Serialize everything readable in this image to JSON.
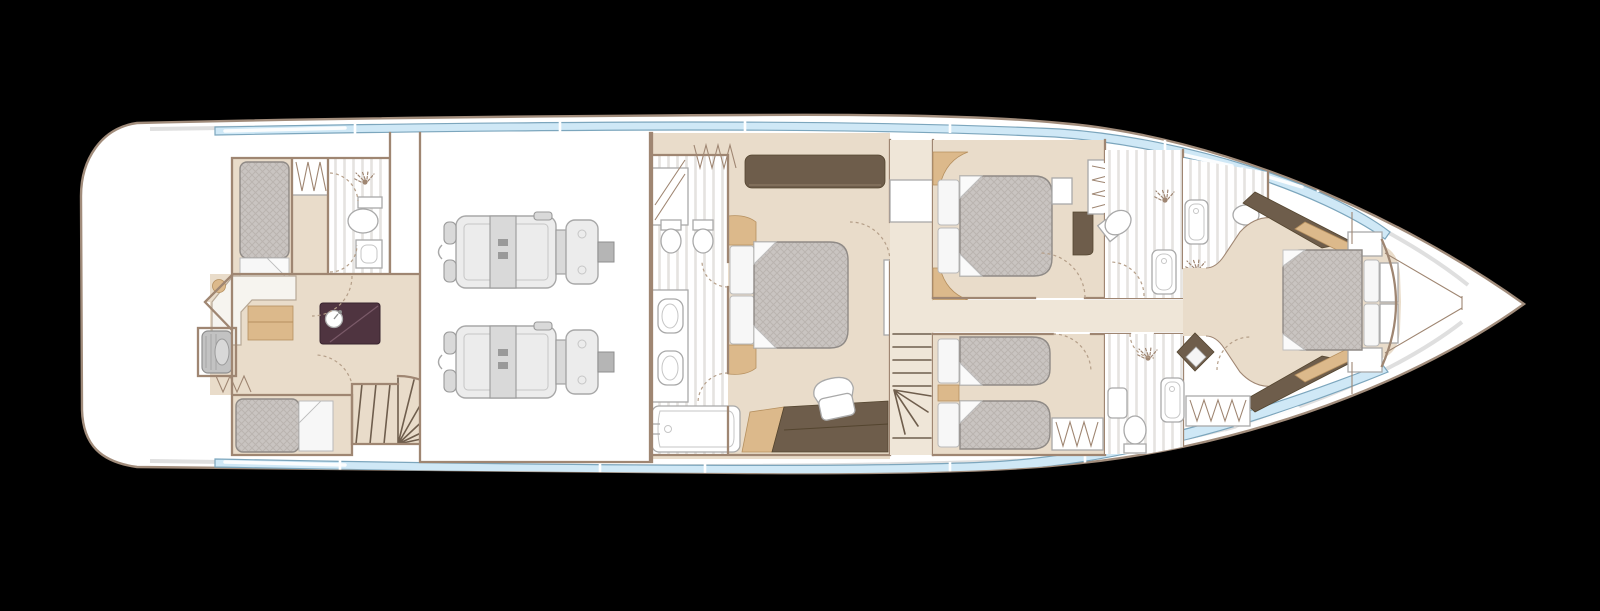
{
  "canvas": {
    "width": 1600,
    "height": 611,
    "background": "#000000"
  },
  "colors": {
    "background": "#000000",
    "hullFill": "#ffffff",
    "hullStroke": "#a18c7b",
    "deckShadow": "#d9d9d9",
    "glass": "#cfe8f6",
    "glassStroke": "#7ca6bd",
    "wall": "#9f8672",
    "floor": "#e9dcca",
    "floorLight": "#efe6d8",
    "mattress": "#c9c4c1",
    "mattressLine": "#bab4b0",
    "mattressStroke": "#8f8a86",
    "pillow": "#f7f7f7",
    "wood": "#dcb98b",
    "woodStroke": "#b6905f",
    "darkWood": "#6e5d4b",
    "darkWoodStroke": "#54452f",
    "aubergine": "#4f3440",
    "fixtureStroke": "#a9a9a9",
    "stairLine": "#6f5e4d",
    "doorDash": "#b59f89",
    "engineFill": "#ececec",
    "engineStroke": "#a8a8a8"
  },
  "plan": {
    "subject": "motor-yacht lower deck floor plan, bow to the right",
    "rooms": [
      {
        "id": "crew-cabin-port",
        "label": "Crew cabin with single berth"
      },
      {
        "id": "crew-bathroom",
        "label": "Crew shower room with WC and basin"
      },
      {
        "id": "crew-mess",
        "label": "Crew mess with L-sofa, table, galley counter and washing machine"
      },
      {
        "id": "crew-cabin-starboard",
        "label": "Crew cabin with single berth"
      },
      {
        "id": "crew-stairs",
        "label": "Curved crew staircase"
      },
      {
        "id": "engine-room",
        "label": "Engine room with twin engines"
      },
      {
        "id": "master-bathroom",
        "label": "Master en-suite with twin basins, WC, bidet and bathtub"
      },
      {
        "id": "master-stateroom",
        "label": "Full-beam master stateroom with double bed, sofa and dressing table"
      },
      {
        "id": "main-stairs",
        "label": "Main staircase and landing"
      },
      {
        "id": "guest-cabin-double",
        "label": "Guest double cabin with desk and wardrobe"
      },
      {
        "id": "guest-ensuite",
        "label": "Guest bathroom with shower, WC and tub"
      },
      {
        "id": "forward-bathroom",
        "label": "Forward bathroom with tub, shower and WC"
      },
      {
        "id": "guest-cabin-twin",
        "label": "Twin guest cabin with two single beds"
      },
      {
        "id": "twin-ensuite",
        "label": "Twin-cabin bathroom with shower, WC and tub"
      },
      {
        "id": "vip-cabin",
        "label": "Forward VIP cabin with double bed and wardrobe"
      },
      {
        "id": "bow-void",
        "label": "Bow void / chain locker"
      }
    ],
    "furniture_counts": {
      "engines": 2,
      "staircases": 3,
      "double_beds": 3,
      "single_beds": 4,
      "bathtubs": 4,
      "toilets": 6
    }
  }
}
